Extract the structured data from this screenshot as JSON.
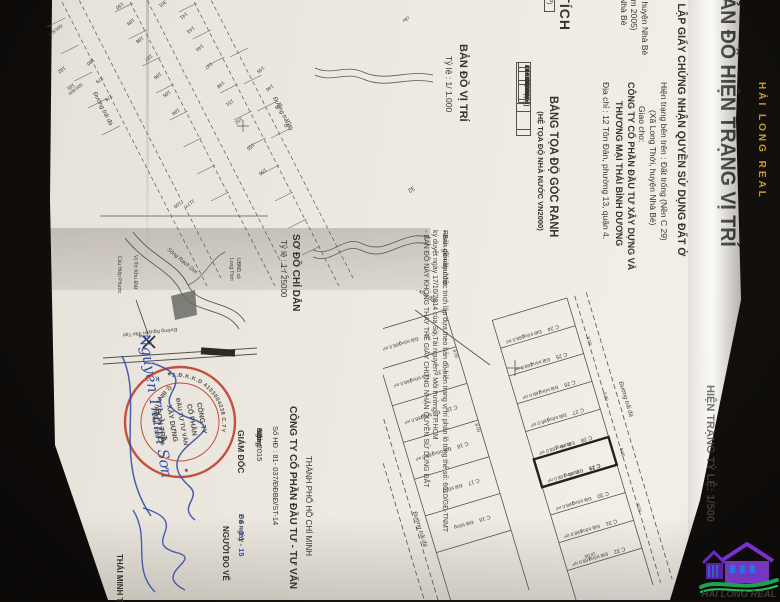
{
  "colors": {
    "stamp_red": "#c0392b",
    "pen_blue": "#3450a8",
    "watermark_gold": "#d7a531",
    "logo_purple": "#7a2fd0",
    "logo_green": "#1fa34a",
    "logo_blue": "#2f6fe0"
  },
  "photo": {
    "watermark_vertical": "HẢI LONG REAL"
  },
  "logo": {
    "text": "HAI LONG REAL"
  },
  "header": {
    "title": "BẢN ĐỒ HIỆN TRẠNG VỊ TRÍ",
    "subtitle": "ĐỂ LẬP GIẤY CHỨNG NHẬN QUYỀN SỬ DỤNG ĐẤT Ở",
    "status_line": "Hiện trạng bên trên : Đất trống (Nền C 29)",
    "location_line": "(Xã Long Thới, huyện Nhà Bè)",
    "assign_label": "Giao cho:",
    "company_line1": "CÔNG TY CỔ PHẦN ĐẦU TƯ XÂY DỰNG VÀ",
    "company_line2": "THƯƠNG MẠI THÁI BÌNH DƯƠNG",
    "address_line": "Địa chỉ : 12 Tôn Đản, phường 13, quận 4.",
    "fragments": "di, huyện Nhà Bè\nnăm 2005)\nn Nhà Bè"
  },
  "area_table": {
    "title": "DIỆN TÍCH",
    "col1": "Diện tích (m²)",
    "col2": "Còn lại",
    "row_label1": "Công",
    "row_label2": "giao",
    "val1": "8.0",
    "val2": "8.0 m²"
  },
  "coord_table": {
    "title": "BẢNG TỌA ĐỘ GÓC RANH",
    "subtitle": "(HỆ TỌA ĐỘ NHÀ NƯỚC VN2000)",
    "headers": [
      "ĐIỂM",
      "X(m)",
      "Y(m)",
      "Cạnh"
    ],
    "rows": [
      [
        "1",
        "1177154.62",
        "606788.34",
        "8.00"
      ],
      [
        "2",
        "1177157.99",
        "606795.59",
        "21.00"
      ],
      [
        "3",
        "1177138.94",
        "606804.44",
        "8.00"
      ],
      [
        "4",
        "1177135.57",
        "606797.19",
        "21.00"
      ],
      [
        "1",
        "1177154.62",
        "606788.34",
        ""
      ]
    ]
  },
  "notes": {
    "legend_dashes": "— — — — ·",
    "legend_label": "Ranh giới khu đất",
    "note1a": "◦ Bản đồ này được trích lập dựa theo bản đồ hiện trạng vị trí phân lô tổng thể số: 6610/GĐ-TNMT",
    "note1b": "   ký duyệt ngày 17/10/2014 của Sở Tài nguyên - Môi trường TP.HCM",
    "note2": "◦ BẢN ĐỒ NÀY KHÔNG THAY THẾ GIẤY CHỨNG NHẬN QUYỀN SỬ DỤNG ĐẤT"
  },
  "map_500": {
    "side_title": "HIỆN TRẠNG TỶ LỆ: 1/500",
    "road_label": "Đường trải đá",
    "pointer_label": "Vị trí khu đất",
    "parcel_status": "Đất trống",
    "parcel_area": "168.0 m²",
    "dim_short": "8.00",
    "dim_long": "21.00",
    "dim_alt": "10.00",
    "row1": [
      "C 24",
      "C 25",
      "C 26",
      "C 27",
      "C 28",
      "C 29",
      "C 30",
      "C 31",
      "C 32"
    ],
    "row2": [
      "C 21",
      "C 20",
      "C 19",
      "C 18",
      "C 17",
      "C 16"
    ]
  },
  "map_1000": {
    "title": "BẢN ĐỒ VỊ TRÍ",
    "scale": "Tỷ lệ : 1/ 1.000",
    "road_label": "Đường trải đá",
    "canal_label": "cầu",
    "grid_label1": "606,800",
    "grid_label2": "606,600",
    "numbers": [
      "301",
      "141",
      "143",
      "144",
      "147",
      "148",
      "151",
      "152",
      "155",
      "156",
      "145",
      "146",
      "149",
      "150",
      "189",
      "188",
      "187",
      "186",
      "185",
      "184",
      "190",
      "180",
      "179",
      "178",
      "181",
      "182",
      "32",
      "1177",
      "100"
    ]
  },
  "index_map": {
    "title": "SƠ ĐỒ CHỈ DẪN",
    "scale": "Tỷ lệ : 1 / 25000",
    "river_label": "Sông Rạch Dơi",
    "ubnd_line1": "UBND xã",
    "ubnd_line2": "Long Thới",
    "site_label": "Vị Trí Khu Đất",
    "bridge_label": "Cầu Hiệp Phước",
    "road_label": "Đường Nguyễn Văn Tạo"
  },
  "signing": {
    "city_line": "THÀNH PHỐ HỒ CHÍ MINH",
    "company_line": "CÔNG TY CỔ PHẦN ĐẦU TƯ - TƯ VẤN",
    "contract_line": "Số HĐ : 81- 037/ĐĐBĐ/ST-14",
    "date_prefix": "Ngày",
    "date_day": "0 3",
    "date_mid": "tháng",
    "date_month": "3",
    "date_year": "năm 2015",
    "director_label": "GIÁM ĐỐC",
    "measure_label": "Đo ngày",
    "measure_date": "2 6 - 0 1 - 15",
    "surveyor_label": "NGƯỜI ĐO VẼ",
    "surveyor_name": "THÁI MINH TH",
    "director_name": "Nguyễn Thành Sơn",
    "stamp": {
      "l1": "CÔNG TY",
      "l2": "CỔ PHẦN",
      "l3": "ĐẦU TƯ TƯ VẤN",
      "l4": "XÂY DỰNG",
      "l5": "SƠN TRÀ",
      "rim_top": "S.Đ.K.K.D 4103004238 C.TY",
      "rim_bottom": "Q. BÌNH THẠNH - TP.HCM",
      "star_left": "★",
      "star_right": "★"
    }
  }
}
